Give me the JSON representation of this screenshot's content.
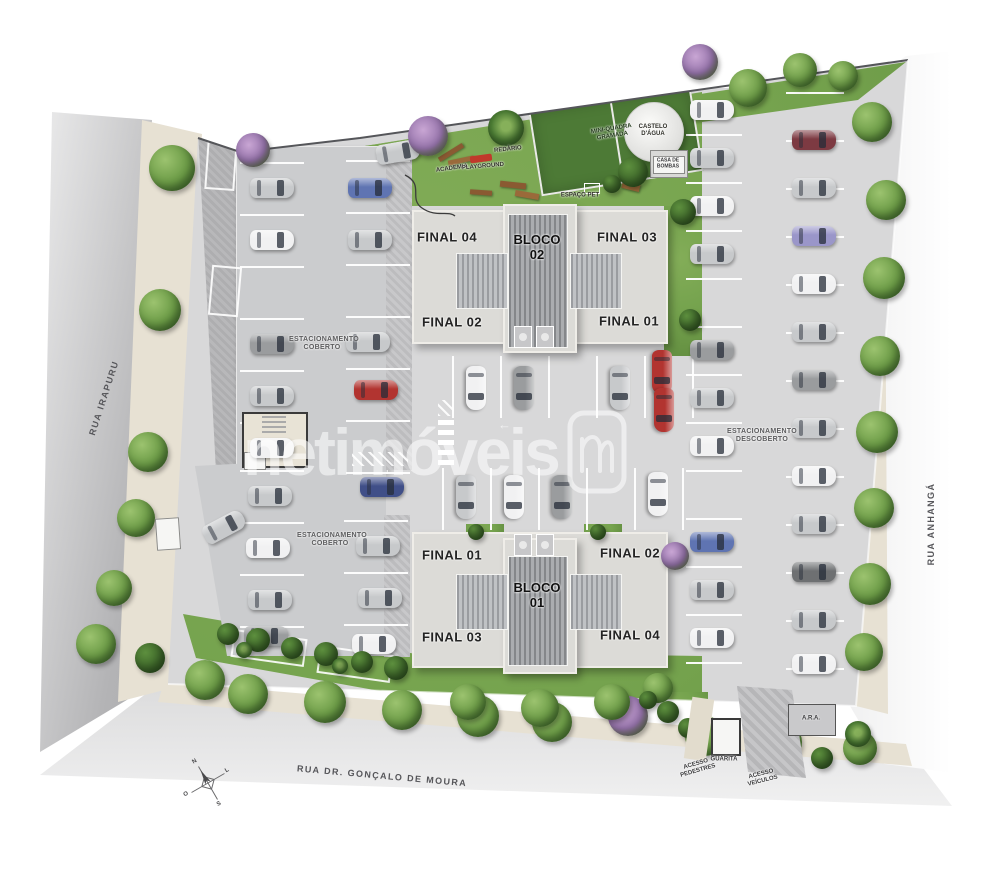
{
  "watermark": {
    "brand": "netimóveis"
  },
  "streets": {
    "left": "RUA IRAPURU",
    "right": "RUA ANHANGÁ",
    "bottom": "RUA DR. GONÇALO DE MOURA"
  },
  "blocks": {
    "bloco02": {
      "name": "BLOCO 02",
      "units": {
        "top_left": "FINAL 04",
        "top_right": "FINAL 03",
        "bottom_left": "FINAL 02",
        "bottom_right": "FINAL 01"
      }
    },
    "bloco01": {
      "name": "BLOCO 01",
      "units": {
        "top_left": "FINAL 01",
        "top_right": "FINAL 02",
        "bottom_left": "FINAL 03",
        "bottom_right": "FINAL 04"
      }
    }
  },
  "parking": {
    "covered_top": "ESTACIONAMENTO COBERTO",
    "covered_bottom": "ESTACIONAMENTO COBERTO",
    "uncovered": "ESTACIONAMENTO DESCOBERTO"
  },
  "amenities": {
    "academia": "ACADEMIA",
    "playground": "PLAYGROUND",
    "redario": "REDÁRIO",
    "mini_quadra": "MINI-QUADRA GRAMADA",
    "castelo": "CASTELO D'ÁGUA",
    "casa_bombas": "CASA DE BOMBAS",
    "espaco_pet": "ESPAÇO PET"
  },
  "access": {
    "guarita": "GUARITA",
    "pedestres": "ACESSO PEDESTRES",
    "veiculos": "ACESSO VEÍCULOS",
    "ara": "A.R.A."
  },
  "compass": {
    "n": "N",
    "s": "S",
    "e": "L",
    "w": "O"
  },
  "colors": {
    "grass": "#74a24d",
    "street": "#a2a2a4",
    "paving": "#d8d8d9",
    "court": "#4d7a36",
    "red_car": "#b23430",
    "watermark": "rgba(255,255,255,0.55)"
  },
  "site": {
    "cars": [
      {
        "x": 272,
        "y": 188,
        "r": 0,
        "c": "silver"
      },
      {
        "x": 272,
        "y": 240,
        "r": 0,
        "c": "white"
      },
      {
        "x": 272,
        "y": 344,
        "r": 0,
        "c": "gray"
      },
      {
        "x": 272,
        "y": 396,
        "r": 0,
        "c": "silver"
      },
      {
        "x": 272,
        "y": 448,
        "r": 0,
        "c": "white"
      },
      {
        "x": 370,
        "y": 188,
        "r": 0,
        "c": "blue"
      },
      {
        "x": 370,
        "y": 240,
        "r": 0,
        "c": "silver"
      },
      {
        "x": 368,
        "y": 342,
        "r": 0,
        "c": "silver"
      },
      {
        "x": 376,
        "y": 390,
        "r": 0,
        "c": "red"
      },
      {
        "x": 398,
        "y": 152,
        "r": -10,
        "c": "silver"
      },
      {
        "x": 270,
        "y": 496,
        "r": 0,
        "c": "silver"
      },
      {
        "x": 268,
        "y": 548,
        "r": 0,
        "c": "white"
      },
      {
        "x": 270,
        "y": 600,
        "r": 0,
        "c": "silver"
      },
      {
        "x": 266,
        "y": 636,
        "r": 0,
        "c": "gray"
      },
      {
        "x": 224,
        "y": 527,
        "r": -28,
        "c": "silver"
      },
      {
        "x": 382,
        "y": 487,
        "r": 0,
        "c": "dblue"
      },
      {
        "x": 378,
        "y": 546,
        "r": 0,
        "c": "silver"
      },
      {
        "x": 380,
        "y": 598,
        "r": 0,
        "c": "silver"
      },
      {
        "x": 374,
        "y": 644,
        "r": 0,
        "c": "white"
      },
      {
        "x": 476,
        "y": 388,
        "r": 90,
        "c": "white"
      },
      {
        "x": 524,
        "y": 388,
        "r": 90,
        "c": "gray"
      },
      {
        "x": 620,
        "y": 388,
        "r": 90,
        "c": "silver"
      },
      {
        "x": 662,
        "y": 372,
        "r": 90,
        "c": "red"
      },
      {
        "x": 664,
        "y": 410,
        "r": 90,
        "c": "red"
      },
      {
        "x": 466,
        "y": 497,
        "r": 90,
        "c": "silver"
      },
      {
        "x": 514,
        "y": 497,
        "r": 90,
        "c": "white"
      },
      {
        "x": 562,
        "y": 497,
        "r": 90,
        "c": "gray"
      },
      {
        "x": 658,
        "y": 494,
        "r": 90,
        "c": "white"
      },
      {
        "x": 712,
        "y": 110,
        "r": 0,
        "c": "white"
      },
      {
        "x": 712,
        "y": 158,
        "r": 0,
        "c": "silver"
      },
      {
        "x": 712,
        "y": 206,
        "r": 0,
        "c": "white"
      },
      {
        "x": 712,
        "y": 254,
        "r": 0,
        "c": "silver"
      },
      {
        "x": 712,
        "y": 350,
        "r": 0,
        "c": "gray"
      },
      {
        "x": 712,
        "y": 398,
        "r": 0,
        "c": "silver"
      },
      {
        "x": 712,
        "y": 446,
        "r": 0,
        "c": "white"
      },
      {
        "x": 712,
        "y": 542,
        "r": 0,
        "c": "blue"
      },
      {
        "x": 712,
        "y": 590,
        "r": 0,
        "c": "silver"
      },
      {
        "x": 712,
        "y": 638,
        "r": 0,
        "c": "white"
      },
      {
        "x": 814,
        "y": 140,
        "r": 0,
        "c": "maroon"
      },
      {
        "x": 814,
        "y": 188,
        "r": 0,
        "c": "silver"
      },
      {
        "x": 814,
        "y": 236,
        "r": 0,
        "c": "violet"
      },
      {
        "x": 814,
        "y": 284,
        "r": 0,
        "c": "white"
      },
      {
        "x": 814,
        "y": 332,
        "r": 0,
        "c": "silver"
      },
      {
        "x": 814,
        "y": 380,
        "r": 0,
        "c": "gray"
      },
      {
        "x": 814,
        "y": 428,
        "r": 0,
        "c": "silver"
      },
      {
        "x": 814,
        "y": 476,
        "r": 0,
        "c": "white"
      },
      {
        "x": 814,
        "y": 524,
        "r": 0,
        "c": "silver"
      },
      {
        "x": 814,
        "y": 572,
        "r": 0,
        "c": "dgray"
      },
      {
        "x": 814,
        "y": 620,
        "r": 0,
        "c": "silver"
      },
      {
        "x": 814,
        "y": 664,
        "r": 0,
        "c": "white"
      },
      {
        "x": 934,
        "y": 100,
        "r": 100,
        "c": "white"
      }
    ],
    "trees": [
      {
        "x": 172,
        "y": 168,
        "d": 46,
        "v": "g"
      },
      {
        "x": 160,
        "y": 310,
        "d": 42,
        "v": "g"
      },
      {
        "x": 148,
        "y": 452,
        "d": 40,
        "v": "g"
      },
      {
        "x": 136,
        "y": 518,
        "d": 38,
        "v": "g"
      },
      {
        "x": 114,
        "y": 588,
        "d": 36,
        "v": "g"
      },
      {
        "x": 96,
        "y": 644,
        "d": 40,
        "v": "g"
      },
      {
        "x": 150,
        "y": 658,
        "d": 30,
        "v": "d"
      },
      {
        "x": 205,
        "y": 680,
        "d": 40,
        "v": "g"
      },
      {
        "x": 253,
        "y": 150,
        "d": 34,
        "v": "p"
      },
      {
        "x": 428,
        "y": 136,
        "d": 40,
        "v": "p"
      },
      {
        "x": 506,
        "y": 128,
        "d": 36,
        "v": "m"
      },
      {
        "x": 700,
        "y": 62,
        "d": 36,
        "v": "p"
      },
      {
        "x": 748,
        "y": 88,
        "d": 38,
        "v": "g"
      },
      {
        "x": 800,
        "y": 70,
        "d": 34,
        "v": "g"
      },
      {
        "x": 843,
        "y": 76,
        "d": 30,
        "v": "g"
      },
      {
        "x": 872,
        "y": 122,
        "d": 40,
        "v": "g"
      },
      {
        "x": 886,
        "y": 200,
        "d": 40,
        "v": "g"
      },
      {
        "x": 884,
        "y": 278,
        "d": 42,
        "v": "g"
      },
      {
        "x": 880,
        "y": 356,
        "d": 40,
        "v": "g"
      },
      {
        "x": 877,
        "y": 432,
        "d": 42,
        "v": "g"
      },
      {
        "x": 874,
        "y": 508,
        "d": 40,
        "v": "g"
      },
      {
        "x": 870,
        "y": 584,
        "d": 42,
        "v": "g"
      },
      {
        "x": 864,
        "y": 652,
        "d": 38,
        "v": "g"
      },
      {
        "x": 248,
        "y": 694,
        "d": 40,
        "v": "g"
      },
      {
        "x": 325,
        "y": 702,
        "d": 42,
        "v": "g"
      },
      {
        "x": 402,
        "y": 710,
        "d": 40,
        "v": "g"
      },
      {
        "x": 478,
        "y": 716,
        "d": 42,
        "v": "g"
      },
      {
        "x": 552,
        "y": 722,
        "d": 40,
        "v": "g"
      },
      {
        "x": 628,
        "y": 716,
        "d": 40,
        "v": "p"
      },
      {
        "x": 705,
        "y": 736,
        "d": 40,
        "v": "g"
      },
      {
        "x": 782,
        "y": 742,
        "d": 40,
        "v": "g"
      },
      {
        "x": 860,
        "y": 748,
        "d": 34,
        "v": "g"
      },
      {
        "x": 468,
        "y": 702,
        "d": 36,
        "v": "g"
      },
      {
        "x": 540,
        "y": 708,
        "d": 38,
        "v": "g"
      },
      {
        "x": 612,
        "y": 702,
        "d": 36,
        "v": "g"
      },
      {
        "x": 658,
        "y": 688,
        "d": 30,
        "v": "g"
      },
      {
        "x": 675,
        "y": 556,
        "d": 28,
        "v": "p"
      },
      {
        "x": 683,
        "y": 212,
        "d": 26,
        "v": "d"
      },
      {
        "x": 690,
        "y": 320,
        "d": 22,
        "v": "d"
      },
      {
        "x": 633,
        "y": 172,
        "d": 30,
        "v": "d"
      },
      {
        "x": 612,
        "y": 184,
        "d": 18,
        "v": "d"
      },
      {
        "x": 228,
        "y": 634,
        "d": 22,
        "v": "d"
      },
      {
        "x": 258,
        "y": 640,
        "d": 24,
        "v": "d"
      },
      {
        "x": 292,
        "y": 648,
        "d": 22,
        "v": "d"
      },
      {
        "x": 326,
        "y": 654,
        "d": 24,
        "v": "d"
      },
      {
        "x": 362,
        "y": 662,
        "d": 22,
        "v": "d"
      },
      {
        "x": 396,
        "y": 668,
        "d": 24,
        "v": "d"
      },
      {
        "x": 244,
        "y": 650,
        "d": 16,
        "v": "m"
      },
      {
        "x": 340,
        "y": 666,
        "d": 16,
        "v": "m"
      },
      {
        "x": 858,
        "y": 734,
        "d": 26,
        "v": "m"
      },
      {
        "x": 822,
        "y": 758,
        "d": 22,
        "v": "d"
      },
      {
        "x": 668,
        "y": 712,
        "d": 22,
        "v": "d"
      },
      {
        "x": 688,
        "y": 728,
        "d": 20,
        "v": "d"
      },
      {
        "x": 648,
        "y": 700,
        "d": 18,
        "v": "d"
      },
      {
        "x": 476,
        "y": 532,
        "d": 16,
        "v": "d"
      },
      {
        "x": 598,
        "y": 532,
        "d": 16,
        "v": "d"
      }
    ]
  }
}
